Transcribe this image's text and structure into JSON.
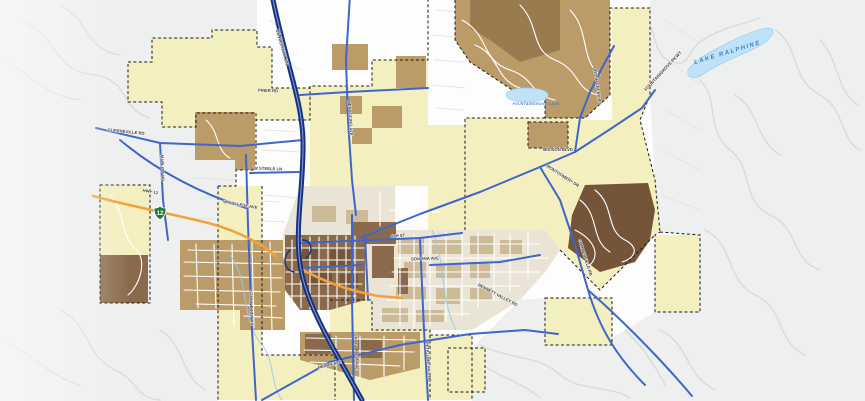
{
  "map": {
    "description": "City zoning and streets GIS map",
    "palette": {
      "background": "#eef0ef",
      "city_white": "#fdfdfd",
      "zone_yellow": "#f4efbe",
      "zone_tan": "#bb9c68",
      "zone_khaki": "#9a7b50",
      "zone_brown": "#8a6a4a",
      "zone_dark_brown": "#74553a",
      "parcel_base": "#eae4d6",
      "parcel_tan": "#cdbb97",
      "water": "#bfe2f8",
      "highway_blue": "#16327e",
      "arterial_blue": "#3f66cc",
      "highway_orange": "#f0a23c",
      "minor_road_gray": "#d9dbdb",
      "boundary_black": "#1a1a1a",
      "road_label": "#3c3c3c",
      "water_label": "#3e7dc0",
      "shield_green": "#1e7a3c"
    },
    "shields": [
      {
        "route": "12"
      }
    ],
    "labels": [
      {
        "t": "US HIGHWAY 101",
        "x": 281,
        "y": 48,
        "r": 74,
        "s": 4.6,
        "c": "road"
      },
      {
        "t": "PINER RD",
        "x": 268,
        "y": 92,
        "r": 2,
        "s": 4.2,
        "c": "road"
      },
      {
        "t": "GUERNEVILLE RD",
        "x": 126,
        "y": 133,
        "r": 6,
        "s": 4.2,
        "c": "road"
      },
      {
        "t": "MARLOW RD",
        "x": 161,
        "y": 168,
        "r": 88,
        "s": 4.2,
        "c": "road"
      },
      {
        "t": "W STEELE LN",
        "x": 268,
        "y": 170,
        "r": 2,
        "s": 4.2,
        "c": "road"
      },
      {
        "t": "MENDOCINO AVE",
        "x": 349,
        "y": 118,
        "r": 86,
        "s": 4.2,
        "c": "road"
      },
      {
        "t": "W COLLEGE AVE",
        "x": 240,
        "y": 206,
        "r": 10,
        "s": 4.2,
        "c": "road"
      },
      {
        "t": "HWY 12",
        "x": 150,
        "y": 193,
        "r": 10,
        "s": 4.2,
        "c": "road"
      },
      {
        "t": "4TH ST",
        "x": 398,
        "y": 237,
        "r": -4,
        "s": 4.2,
        "c": "road"
      },
      {
        "t": "SONOMA AVE",
        "x": 425,
        "y": 260,
        "r": -2,
        "s": 4.2,
        "c": "road"
      },
      {
        "t": "SANTA ROSA AVE",
        "x": 355,
        "y": 352,
        "r": 88,
        "s": 4.2,
        "c": "road"
      },
      {
        "t": "PETALUMA HILL RD",
        "x": 427,
        "y": 362,
        "r": 86,
        "s": 4.2,
        "c": "road"
      },
      {
        "t": "STONY POINT RD",
        "x": 250,
        "y": 308,
        "r": 88,
        "s": 4.2,
        "c": "road"
      },
      {
        "t": "MONTGOMERY DR",
        "x": 562,
        "y": 177,
        "r": 33,
        "s": 4.2,
        "c": "road"
      },
      {
        "t": "MISSION BLVD",
        "x": 558,
        "y": 151,
        "r": 0,
        "s": 4.2,
        "c": "road"
      },
      {
        "t": "SUMMERFIELD RD",
        "x": 584,
        "y": 258,
        "r": 72,
        "s": 4.2,
        "c": "road"
      },
      {
        "t": "FOUNTAINGROVE PKWY",
        "x": 664,
        "y": 72,
        "r": -47,
        "s": 4.4,
        "c": "road"
      },
      {
        "t": "BRUSH CREEK RD",
        "x": 596,
        "y": 86,
        "r": 82,
        "s": 4.2,
        "c": "road"
      },
      {
        "t": "HEARN AVE",
        "x": 330,
        "y": 366,
        "r": -14,
        "s": 4.2,
        "c": "road"
      },
      {
        "t": "BENNETT VALLEY RD",
        "x": 497,
        "y": 296,
        "r": 28,
        "s": 4.2,
        "c": "road"
      },
      {
        "t": "LAKE RALPHINE",
        "x": 728,
        "y": 54,
        "r": -17,
        "s": 6,
        "c": "water",
        "ls": 1.6
      },
      {
        "t": "FOUNTAINGROVE LAKE",
        "x": 536,
        "y": 105,
        "r": 0,
        "s": 3.4,
        "c": "water",
        "ls": 0.4
      }
    ]
  }
}
